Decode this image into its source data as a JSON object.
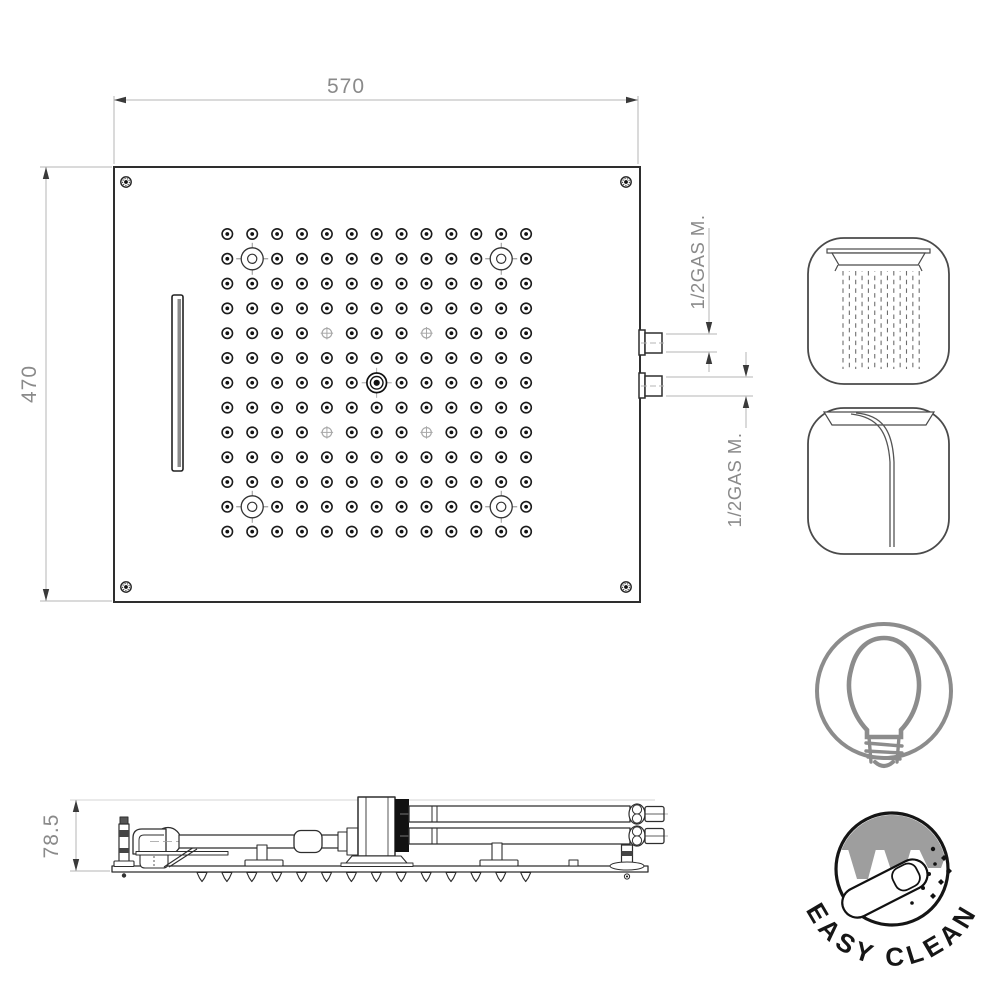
{
  "top_view": {
    "width_label": "570",
    "height_label": "470",
    "connector_top_label": "1/2GAS M.",
    "connector_bottom_label": "1/2GAS M.",
    "grid": {
      "rows": 13,
      "cols": 13,
      "col_start": 227.3,
      "col_step": 24.9,
      "row_start": 234,
      "row_step": 24.8,
      "big_nozzles": [
        [
          2,
          2
        ],
        [
          2,
          12
        ],
        [
          12,
          2
        ],
        [
          12,
          12
        ]
      ],
      "cross_nozzles": [
        [
          5,
          5
        ],
        [
          5,
          9
        ],
        [
          9,
          5
        ],
        [
          9,
          9
        ]
      ],
      "center_nozzle": [
        7,
        7
      ]
    }
  },
  "side_view": {
    "height_label": "78.5",
    "nozzle_count": 14
  },
  "icons": {
    "rain": {
      "name": "rain-shower-icon"
    },
    "waterfall": {
      "name": "waterfall-icon"
    },
    "light": {
      "name": "light-bulb-icon"
    },
    "easy_clean": {
      "label": "EASY CLEAN"
    }
  },
  "colors": {
    "line": "#2e2e2e",
    "dim_line": "#b5b5b5",
    "dim_text": "#8a8a8a",
    "icon_gray": "#8c8c8c",
    "badge_gray": "#9e9e9e",
    "black": "#111111"
  }
}
